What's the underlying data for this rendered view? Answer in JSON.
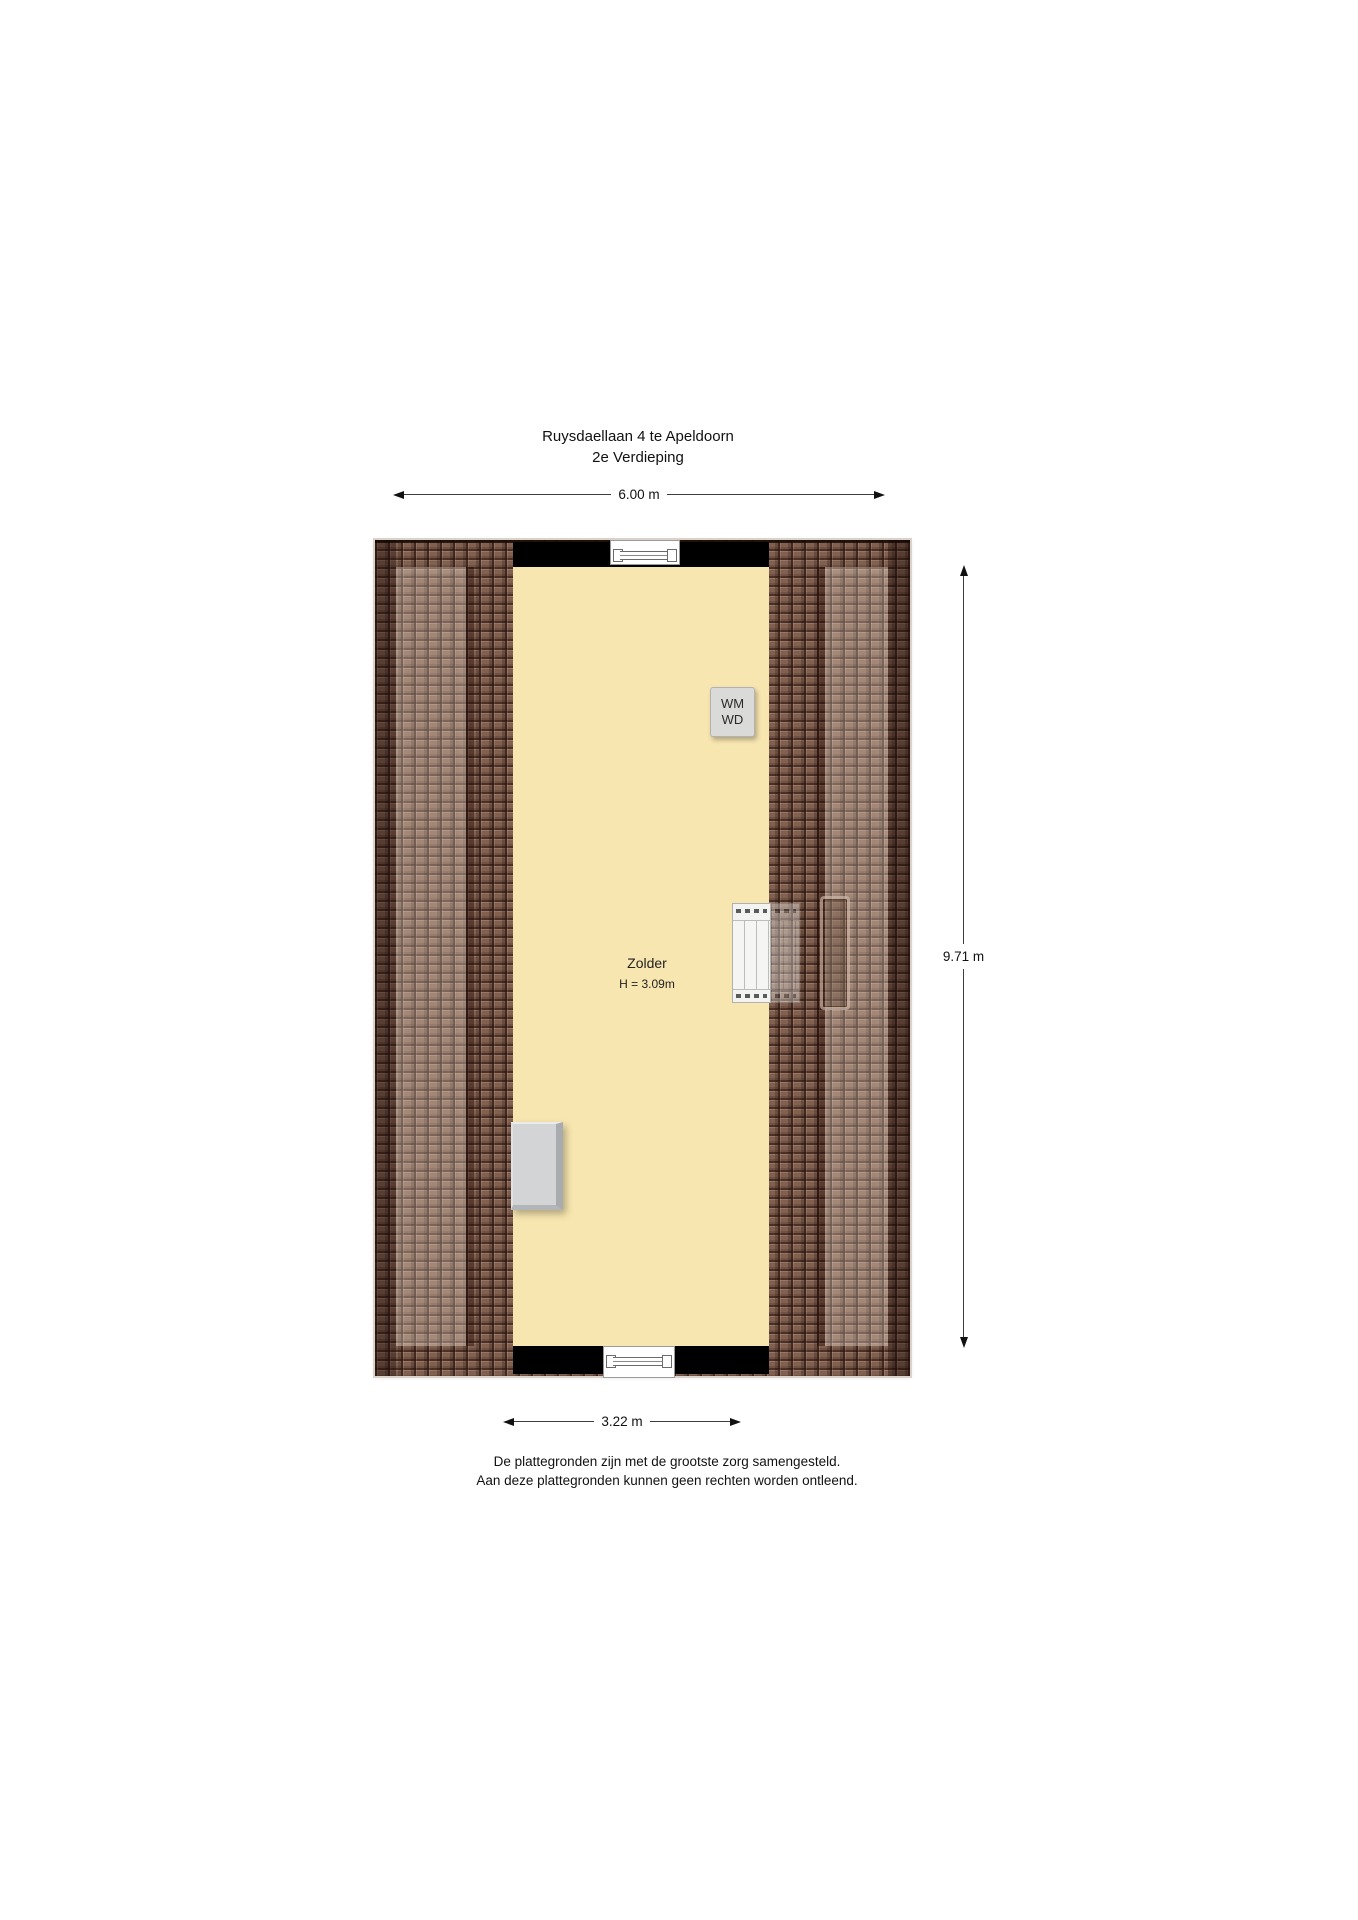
{
  "title": {
    "line1": "Ruysdaellaan 4 te Apeldoorn",
    "line2": "2e Verdieping"
  },
  "dimensions": {
    "top": "6.00 m",
    "right": "9.71 m",
    "bottom": "3.22 m"
  },
  "floorplan": {
    "floor_name": "2e Verdieping",
    "room": {
      "name": "Zolder",
      "height_label": "H = 3.09m",
      "ceiling_height_m": 3.09
    },
    "appliance": {
      "line1": "WM",
      "line2": "WD"
    },
    "measurements_m": {
      "outer_width": 6.0,
      "depth": 9.71,
      "inner_width": 3.22
    }
  },
  "disclaimer": {
    "line1": "De plattegronden zijn met de grootste zorg samengesteld.",
    "line2": "Aan deze plattegronden kunnen geen rechten worden ontleend."
  },
  "colors": {
    "background": "#ffffff",
    "room_fill": "#f8e6b0",
    "roof_tiles_base": "#82604f",
    "roof_tiles_dark": "#4a2f22",
    "roof_tiles_light": "#a3826f",
    "wall": "#000000",
    "appliance_fill": "#dadad8",
    "storage_fill": "#d2d4d6",
    "dimension_line": "#3d3d3d",
    "text": "#111111"
  }
}
